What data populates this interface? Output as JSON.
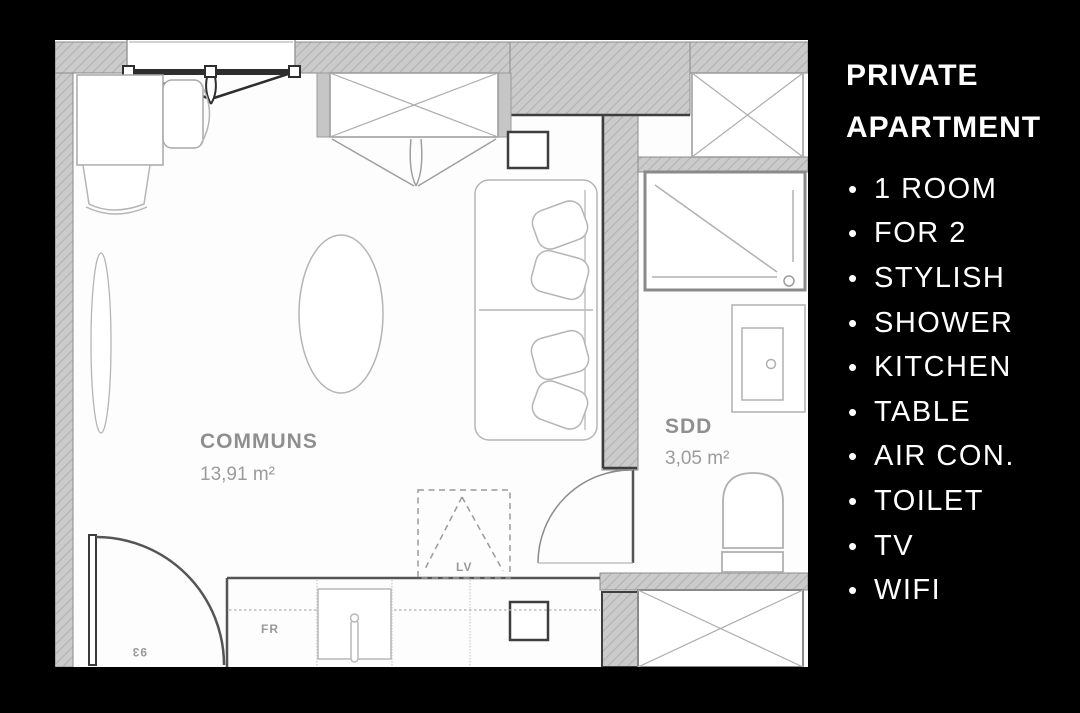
{
  "panel": {
    "title_line1": "PRIVATE",
    "title_line2": "APARTMENT",
    "bullet": "•",
    "items": [
      "1 ROOM",
      "FOR 2",
      "STYLISH",
      "SHOWER",
      "KITCHEN",
      "TABLE",
      "AIR CON.",
      "TOILET",
      "TV",
      "WIFI"
    ]
  },
  "floorplan": {
    "room_main": {
      "name": "COMMUNS",
      "area": "13,91 m²"
    },
    "room_bath": {
      "name": "SDD",
      "area": "3,05 m²"
    },
    "labels": {
      "fridge": "FR",
      "dishwasher": "LV",
      "door_width": "93"
    },
    "colors": {
      "background": "#fdfdfd",
      "wall_fill": "#cbcbcb",
      "wall_hatch": "#b3b3b3",
      "dark_line": "#333333",
      "furniture_line": "#b5b5b5",
      "label_gray": "#8f8f8f",
      "panel_bg": "#000000",
      "panel_text": "#ffffff"
    }
  }
}
